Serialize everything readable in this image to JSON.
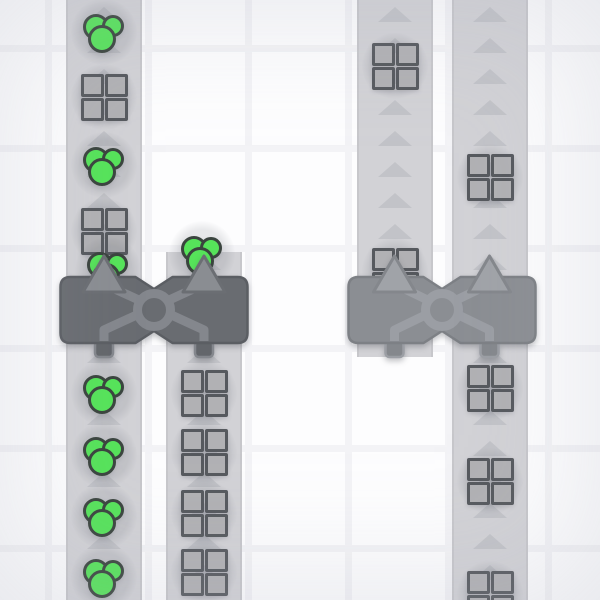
{
  "app": {
    "name": "factory-game-viewport",
    "description": "Top-down factory-building game scene: vertical conveyor belts moving shape items (green circle clusters and gray quad-squares) upward into two 2-tile balancer machines with crossing lanes; right machine rendered in a lighter ghost style. No HUD or text visible."
  },
  "scene": {
    "width": 600,
    "height": 600,
    "tile_size": 100,
    "grid_line_offset": 45,
    "grid_line_thickness": 7,
    "belt_width": 76,
    "belt_direction": "up",
    "belt_arrow_spacing": 31,
    "belt_arrow_phase": 14
  },
  "colors": {
    "background": "#fdfdfe",
    "grid_line": "#f3f3f6",
    "belt": "#d2d2d6",
    "belt_edge": "#c7c7cb",
    "belt_arrow": "#c2c3c8",
    "circle_item_fill": "#56e35a",
    "circle_item_stroke": "#3a443e",
    "square_item_fill": "#b1b1b4",
    "square_item_stroke": "#56595e",
    "machine_solid": {
      "body": "#696c71",
      "body_stroke": "#5b5e63",
      "pipe": "#84878d",
      "arrow_fill": "#8a8d92",
      "arrow_stroke": "#6b6e73",
      "foot": "#63666b"
    },
    "machine_ghost": {
      "body": "#8b8e93",
      "body_stroke": "#7d8085",
      "pipe": "#9b9ea4",
      "arrow_fill": "#a0a3a8",
      "arrow_stroke": "#84878c",
      "foot": "#85888d"
    }
  },
  "belts": [
    {
      "id": "belt-left-a",
      "x_center": 104,
      "y_start": 0,
      "y_end": 600
    },
    {
      "id": "belt-left-b",
      "x_center": 204,
      "y_start": 252,
      "y_end": 600
    },
    {
      "id": "belt-right-a",
      "x_center": 395,
      "y_start": 0,
      "y_end": 357
    },
    {
      "id": "belt-right-b",
      "x_center": 490,
      "y_start": 0,
      "y_end": 600
    }
  ],
  "items": [
    {
      "type": "circles",
      "x": 104,
      "y": 32
    },
    {
      "type": "square",
      "x": 104,
      "y": 97
    },
    {
      "type": "circles",
      "x": 104,
      "y": 165
    },
    {
      "type": "square",
      "x": 104,
      "y": 231
    },
    {
      "type": "circles",
      "x": 108,
      "y": 270
    },
    {
      "type": "circles",
      "x": 104,
      "y": 393
    },
    {
      "type": "circles",
      "x": 104,
      "y": 455
    },
    {
      "type": "circles",
      "x": 104,
      "y": 516
    },
    {
      "type": "circles",
      "x": 104,
      "y": 577
    },
    {
      "type": "circles",
      "x": 202,
      "y": 254
    },
    {
      "type": "square",
      "x": 204,
      "y": 393
    },
    {
      "type": "square",
      "x": 204,
      "y": 452
    },
    {
      "type": "square",
      "x": 204,
      "y": 513
    },
    {
      "type": "square",
      "x": 204,
      "y": 572
    },
    {
      "type": "square",
      "x": 395,
      "y": 66
    },
    {
      "type": "square",
      "x": 395,
      "y": 271
    },
    {
      "type": "square",
      "x": 490,
      "y": 177
    },
    {
      "type": "square",
      "x": 490,
      "y": 388
    },
    {
      "type": "square",
      "x": 490,
      "y": 481
    },
    {
      "type": "square",
      "x": 490,
      "y": 594
    }
  ],
  "machines": [
    {
      "id": "balancer-left",
      "type": "balancer",
      "x_center": 154,
      "y_center": 310,
      "palette": "machine_solid",
      "port_dx": [
        -50,
        50
      ]
    },
    {
      "id": "balancer-right",
      "type": "balancer",
      "x_center": 442,
      "y_center": 310,
      "palette": "machine_ghost",
      "port_dx": [
        -47.5,
        47.5
      ]
    }
  ]
}
